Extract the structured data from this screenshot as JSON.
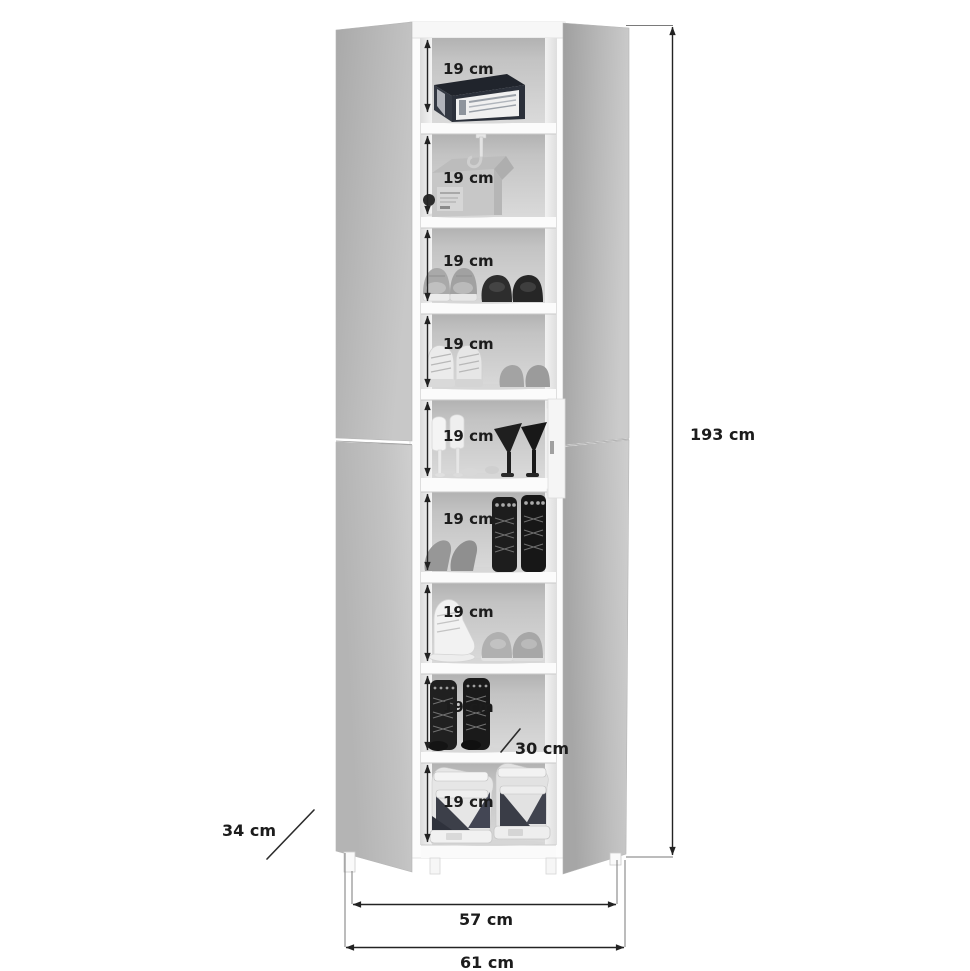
{
  "page": {
    "title": "Shoe cabinet dimension diagram",
    "background": "#ffffff"
  },
  "product": {
    "name": "mirrored-two-door-shoe-cabinet",
    "style": "grayscale product photo with black dimension annotations",
    "compartment_count": 9
  },
  "compartments": [
    {
      "label": "19 cm",
      "content": "dark-shoe-box"
    },
    {
      "label": "19 cm",
      "content": "storage-box-and-wall-hook"
    },
    {
      "label": "19 cm",
      "content": "gray-sneakers-and-dark-loafers"
    },
    {
      "label": "19 cm",
      "content": "white-high-top-sneakers-and-gray-flats"
    },
    {
      "label": "19 cm",
      "content": "white-and-black-high-heels"
    },
    {
      "label": "19 cm",
      "content": "gray-flats-and-black-lace-up-boots"
    },
    {
      "label": "19 cm",
      "content": "white-display-shoe-and-gray-sneakers"
    },
    {
      "label": "19 cm",
      "content": "black-ankle-boots"
    },
    {
      "label": "19 cm",
      "content": "wedge-sneaker-sandals"
    }
  ],
  "dims": {
    "height": "193 cm",
    "front_width": "57 cm",
    "total_width": "61 cm",
    "door_depth": "34 cm",
    "shelf_depth": "30 cm"
  },
  "colors": {
    "annotation": "#1c1c1c",
    "mirror_light": "#cdcdcd",
    "mirror_dark": "#a2a2a2",
    "interior_back_top": "#b2b2b2",
    "interior_back_bottom": "#dadada",
    "cabinet_white": "#fbfbfb"
  }
}
